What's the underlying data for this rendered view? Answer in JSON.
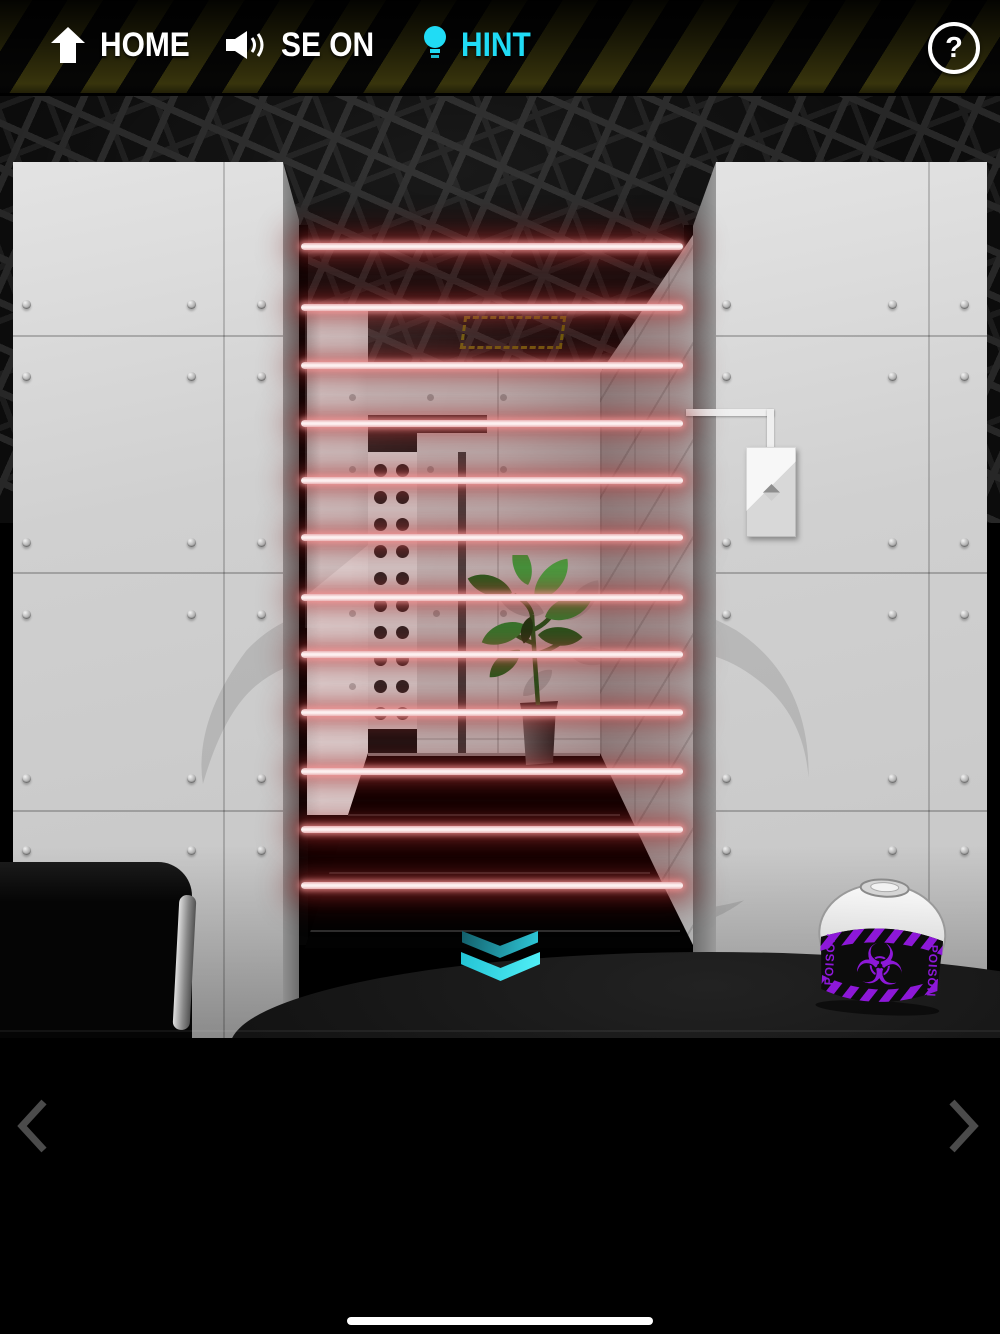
{
  "top_bar": {
    "home_label": "HOME",
    "sound_label": "SE ON",
    "hint_label": "HINT",
    "help_label": "?"
  },
  "scene": {
    "watermark_symbol": "☣",
    "poison_canister": {
      "hazard_symbol": "☣",
      "side_label_left": "POISON",
      "side_label_right": "POISON"
    },
    "laser_grid": {
      "beam_count": 12
    }
  },
  "icons": {
    "home": "up-arrow",
    "sound": "speaker-waves",
    "hint": "lightbulb",
    "help": "question-mark",
    "hatch": "dashed-outline",
    "call_button": "diamond-up-down",
    "down": "double-chevron-down",
    "prev": "chevron-left",
    "next": "chevron-right",
    "hazard": "biohazard"
  },
  "colors": {
    "hint_cyan": "#20dcf5",
    "laser_core": "#fdf0f0",
    "laser_glow": "#d74b4b",
    "poison_purple": "#8d18d8",
    "chevron_cyan": "#3ce4f0",
    "caution_stripe": "#3e3a0e"
  }
}
